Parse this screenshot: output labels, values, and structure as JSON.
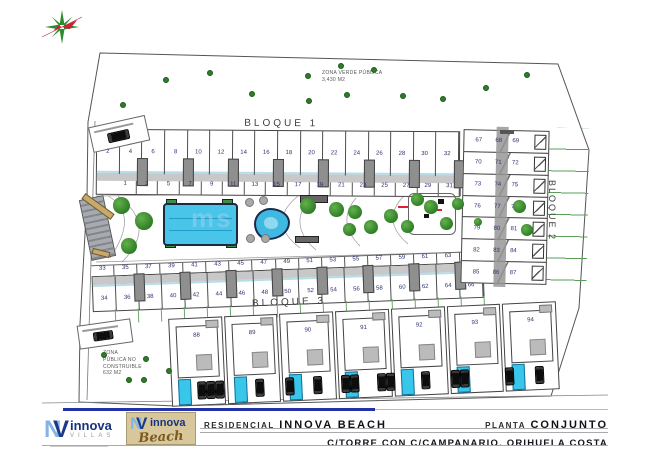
{
  "zona_verde": {
    "line1": "ZONA VERDE PÚBLICA",
    "line2": "3,430 M2"
  },
  "zona_publica": {
    "line1": "ZONA",
    "line2": "PÚBLICA NO",
    "line3": "CONSTRUIBLE",
    "line4": "632 M2"
  },
  "blocks": {
    "bloque1": {
      "label": "BLOQUE 1",
      "top": [
        "2",
        "4",
        "6",
        "8",
        "10",
        "12",
        "14",
        "16",
        "18",
        "20",
        "22",
        "24",
        "26",
        "28",
        "30",
        "32"
      ],
      "bottom": [
        "1",
        "3",
        "5",
        "7",
        "9",
        "11",
        "13",
        "15",
        "17",
        "19",
        "21",
        "23",
        "25",
        "27",
        "29",
        "31"
      ]
    },
    "bloque2": {
      "label": "BLOQUE 2",
      "rows": [
        [
          "67",
          "68",
          "69"
        ],
        [
          "70",
          "71",
          "72"
        ],
        [
          "73",
          "74",
          "75"
        ],
        [
          "76",
          "77",
          "78"
        ],
        [
          "79",
          "80",
          "81"
        ],
        [
          "82",
          "83",
          "84"
        ],
        [
          "85",
          "86",
          "87"
        ]
      ]
    },
    "bloque3": {
      "label": "BLOQUE 3",
      "top": [
        "33",
        "35",
        "37",
        "39",
        "41",
        "43",
        "45",
        "47",
        "49",
        "51",
        "53",
        "55",
        "57",
        "59",
        "61",
        "63",
        "65"
      ],
      "bottom": [
        "34",
        "36",
        "38",
        "40",
        "42",
        "44",
        "46",
        "48",
        "50",
        "52",
        "54",
        "56",
        "58",
        "60",
        "62",
        "64",
        "66"
      ]
    }
  },
  "villas": {
    "numbers": [
      "88",
      "89",
      "90",
      "91",
      "92",
      "93",
      "94"
    ],
    "car_groups": [
      {
        "x": 26,
        "count": 3
      },
      {
        "x": 84,
        "count": 1
      },
      {
        "x": 114,
        "count": 1
      },
      {
        "x": 142,
        "count": 1
      },
      {
        "x": 170,
        "count": 2
      },
      {
        "x": 206,
        "count": 2
      },
      {
        "x": 250,
        "count": 1
      },
      {
        "x": 280,
        "count": 2
      },
      {
        "x": 334,
        "count": 1
      },
      {
        "x": 364,
        "count": 1
      }
    ]
  },
  "landscape": {
    "zona_verde_dots": [
      [
        120,
        102
      ],
      [
        163,
        77
      ],
      [
        207,
        70
      ],
      [
        249,
        91
      ],
      [
        305,
        73
      ],
      [
        338,
        63
      ],
      [
        371,
        67
      ],
      [
        344,
        92
      ],
      [
        400,
        93
      ],
      [
        440,
        96
      ],
      [
        483,
        85
      ],
      [
        524,
        72
      ],
      [
        306,
        98
      ]
    ],
    "zona_publica_dots": [
      [
        101,
        352
      ],
      [
        143,
        356
      ],
      [
        126,
        377
      ],
      [
        141,
        377
      ],
      [
        166,
        368
      ]
    ],
    "trees": [
      [
        121,
        205,
        17
      ],
      [
        144,
        221,
        18
      ],
      [
        129,
        246,
        16
      ],
      [
        308,
        206,
        16
      ],
      [
        336,
        209,
        15
      ],
      [
        355,
        212,
        14
      ],
      [
        349,
        229,
        13
      ],
      [
        371,
        227,
        14
      ],
      [
        391,
        216,
        14
      ],
      [
        407,
        226,
        13
      ],
      [
        417,
        199,
        13
      ],
      [
        431,
        207,
        14
      ],
      [
        446,
        223,
        13
      ],
      [
        458,
        204,
        12
      ],
      [
        519,
        206,
        13
      ],
      [
        527,
        230,
        12
      ],
      [
        478,
        222,
        8
      ]
    ]
  },
  "watermark": "ms",
  "title_block": {
    "project_label": "RESIDENCIAL",
    "project_name": "INNOVA BEACH",
    "sheet_label": "PLANTA",
    "sheet_name": "CONJUNTO",
    "address": "C/TORRE CON C/CAMPANARIO. ORIHUELA COSTA"
  },
  "logos": {
    "villas": {
      "monogram_n": "N",
      "monogram_v": "V",
      "name": "innova",
      "sub": "VILLAS"
    },
    "beach": {
      "monogram_n": "N",
      "monogram_v": "V",
      "name": "innova",
      "script": "Beach"
    }
  },
  "colors": {
    "pool": "#49c5ea",
    "tree": "#2e7d26",
    "accent_blue": "#2431a8",
    "logo_navy": "#16337f",
    "beach_tan": "#d9c79c",
    "number_navy": "#2b3270"
  }
}
